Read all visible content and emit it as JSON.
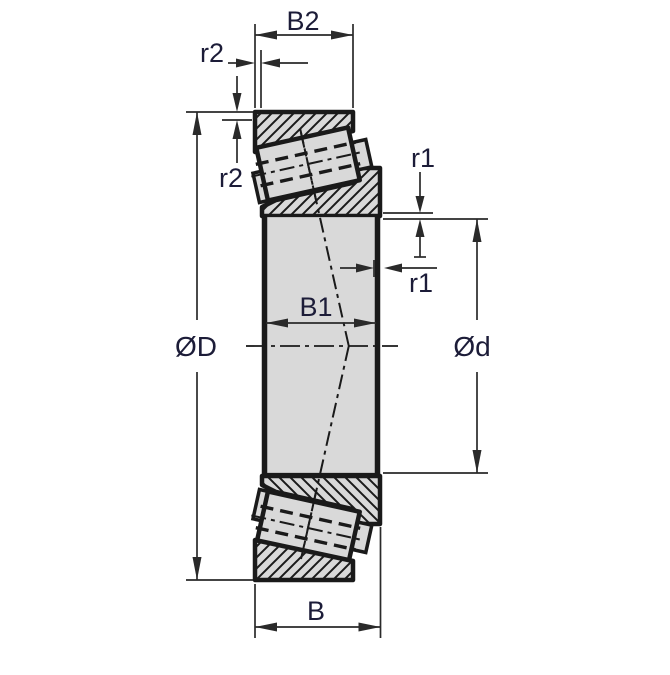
{
  "figure": {
    "type": "technical-drawing",
    "subject": "tapered roller bearing cross-section dimension drawing",
    "labels": {
      "b2": "B2",
      "r2_top": "r2",
      "r2_left": "r2",
      "r1_upper": "r1",
      "r1_lower": "r1",
      "b1": "B1",
      "outer_diameter": "ØD",
      "bore_diameter": "Ød",
      "b": "B"
    },
    "colors": {
      "background": "#ffffff",
      "outline": "#1a1a1a",
      "metal_fill": "#d9d9d9",
      "dimension_line": "#2a2a2a",
      "label_text": "#1c1c38"
    }
  }
}
